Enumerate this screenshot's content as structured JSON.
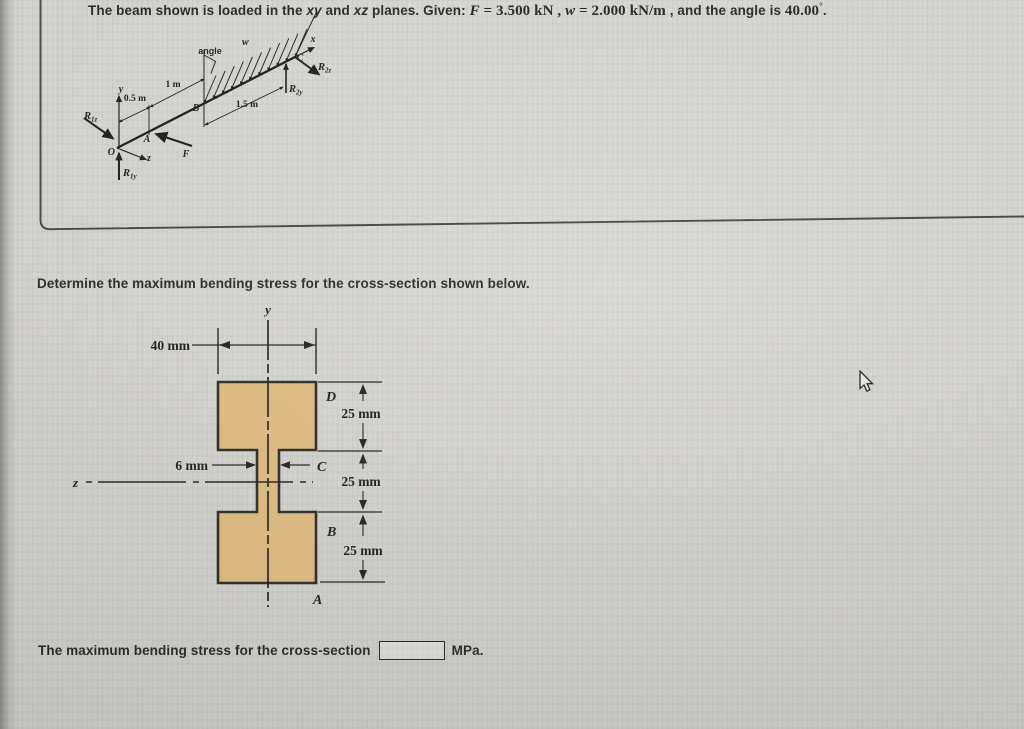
{
  "header": {
    "part1": "The beam shown is loaded in the ",
    "xy": "xy",
    "part2": " and ",
    "xz": "xz",
    "part3": " planes. Given: ",
    "f_sym": "F",
    "f_rest": " = 3.500 kN",
    "sep1": " , ",
    "w_sym": "w",
    "w_rest": " = 2.000 kN/m",
    "part4": " , and the angle is ",
    "angle_value": "40.00",
    "degree": "°",
    "period": "."
  },
  "instruction": "Determine the maximum bending stress for the cross-section shown below.",
  "beam_figure": {
    "labels": {
      "angle": "angle",
      "w": "w",
      "x": "x",
      "y": "y",
      "z": "z",
      "O": "O",
      "A": "A",
      "B": "B",
      "C": "C",
      "F": "F"
    },
    "reactions": {
      "R1z": {
        "base": "R",
        "sub": "1z"
      },
      "R1y": {
        "base": "R",
        "sub": "1y"
      },
      "R2z": {
        "base": "R",
        "sub": "2z"
      },
      "R2y": {
        "base": "R",
        "sub": "2y"
      }
    },
    "dimensions": {
      "OA": "0.5 m",
      "AB": "1 m",
      "BC": "1.5 m"
    }
  },
  "cross_section": {
    "axis_y": "y",
    "axis_z": "z",
    "points": {
      "A": "A",
      "B": "B",
      "C": "C",
      "D": "D"
    },
    "width_label": "40 mm",
    "web_label": "6 mm",
    "segment_labels": [
      "25 mm",
      "25 mm",
      "25 mm"
    ],
    "colors": {
      "fill": "#dfba7d",
      "outline": "#26241d"
    }
  },
  "answer": {
    "prefix": "The maximum bending stress for the cross-section",
    "value": "",
    "unit": "MPa."
  }
}
